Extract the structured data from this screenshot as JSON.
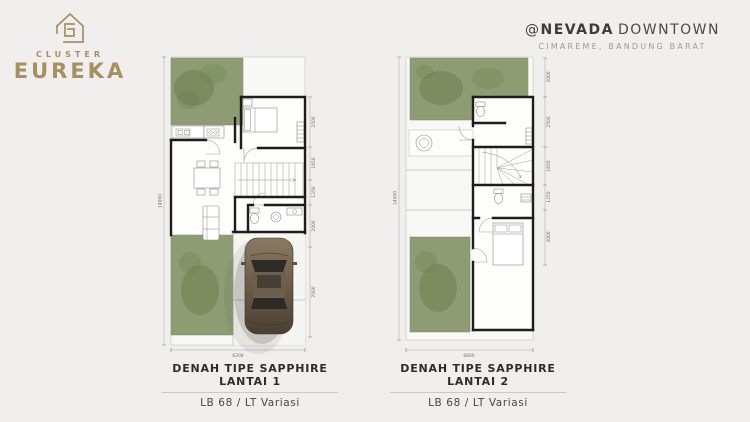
{
  "header": {
    "brand": {
      "cluster": "CLUSTER",
      "name": "EUREKA"
    },
    "project": {
      "prefix": "@",
      "name": "NEVADA",
      "suffix": "DOWNTOWN",
      "location": "CIMAREME, BANDUNG BARAT"
    }
  },
  "plans": [
    {
      "caption_title": "DENAH TIPE SAPPHIRE LANTAI 1",
      "caption_sub": "LB 68 / LT Variasi",
      "dim_left": "14000",
      "dim_bottom": "6200",
      "dims_right": [
        "2500",
        "1650",
        "1250",
        "2000",
        "7000"
      ]
    },
    {
      "caption_title": "DENAH TIPE SAPPHIRE LANTAI 2",
      "caption_sub": "LB 68 / LT Variasi",
      "dim_left": "14000",
      "dim_bottom": "6600",
      "dims_right": [
        "2000",
        "2500",
        "1650",
        "1250",
        "3000"
      ]
    }
  ],
  "colors": {
    "bg": "#f0efed",
    "gold": "#a6905f",
    "ink": "#3c3c3c",
    "muted": "#9b9b9b",
    "grass": "#8e9c74",
    "grass_dark": "#697a48",
    "wall": "#1d1d1b",
    "caption_ink": "#2d2d2d"
  }
}
